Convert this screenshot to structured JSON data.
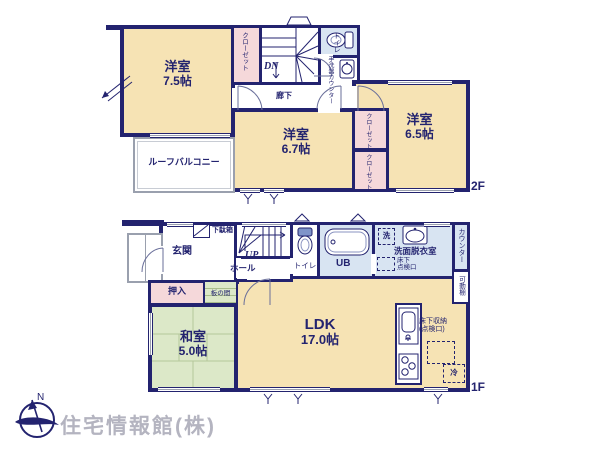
{
  "floor2": {
    "floor_label": "2F",
    "room75": {
      "label": "洋室",
      "size": "7.5帖"
    },
    "room67": {
      "label": "洋室",
      "size": "6.7帖"
    },
    "room65": {
      "label": "洋室",
      "size": "6.5帖"
    },
    "closet": "クローゼット",
    "stairs_dn": "DN",
    "hallway": "廊下",
    "toilet": "トイレ",
    "basin_counter": "手洗器カウンター",
    "balcony": "ルーフバルコニー"
  },
  "floor1": {
    "floor_label": "1F",
    "genkan": "玄関",
    "shoebox": "下駄箱",
    "stairs_up": "UP",
    "hall": "ホール",
    "toilet": "トイレ",
    "bath": "UB",
    "washer": "洗",
    "washroom": "洗面脱衣室",
    "hatch_line1": "床下",
    "hatch_line2": "点検口",
    "counter": "カウンター",
    "shelf": "可動棚",
    "oshiire": "押入",
    "itanoma": "板の間",
    "washitsu": {
      "label": "和室",
      "size": "5.0帖"
    },
    "ldk": {
      "label": "LDK",
      "size": "17.0帖"
    },
    "storage_line1": "床下収納",
    "storage_line2": "(点検口)",
    "fridge": "冷"
  },
  "footer": {
    "company": "住宅情報館(株)",
    "compass_n": "N"
  },
  "colors": {
    "navy": "#23236f",
    "cream": "#f6e3b4",
    "pink": "#f5d8da",
    "blue": "#d8e4f2",
    "green": "#dce8c8",
    "gray": "#9aa0ae",
    "logo": "#b4b4c0"
  }
}
